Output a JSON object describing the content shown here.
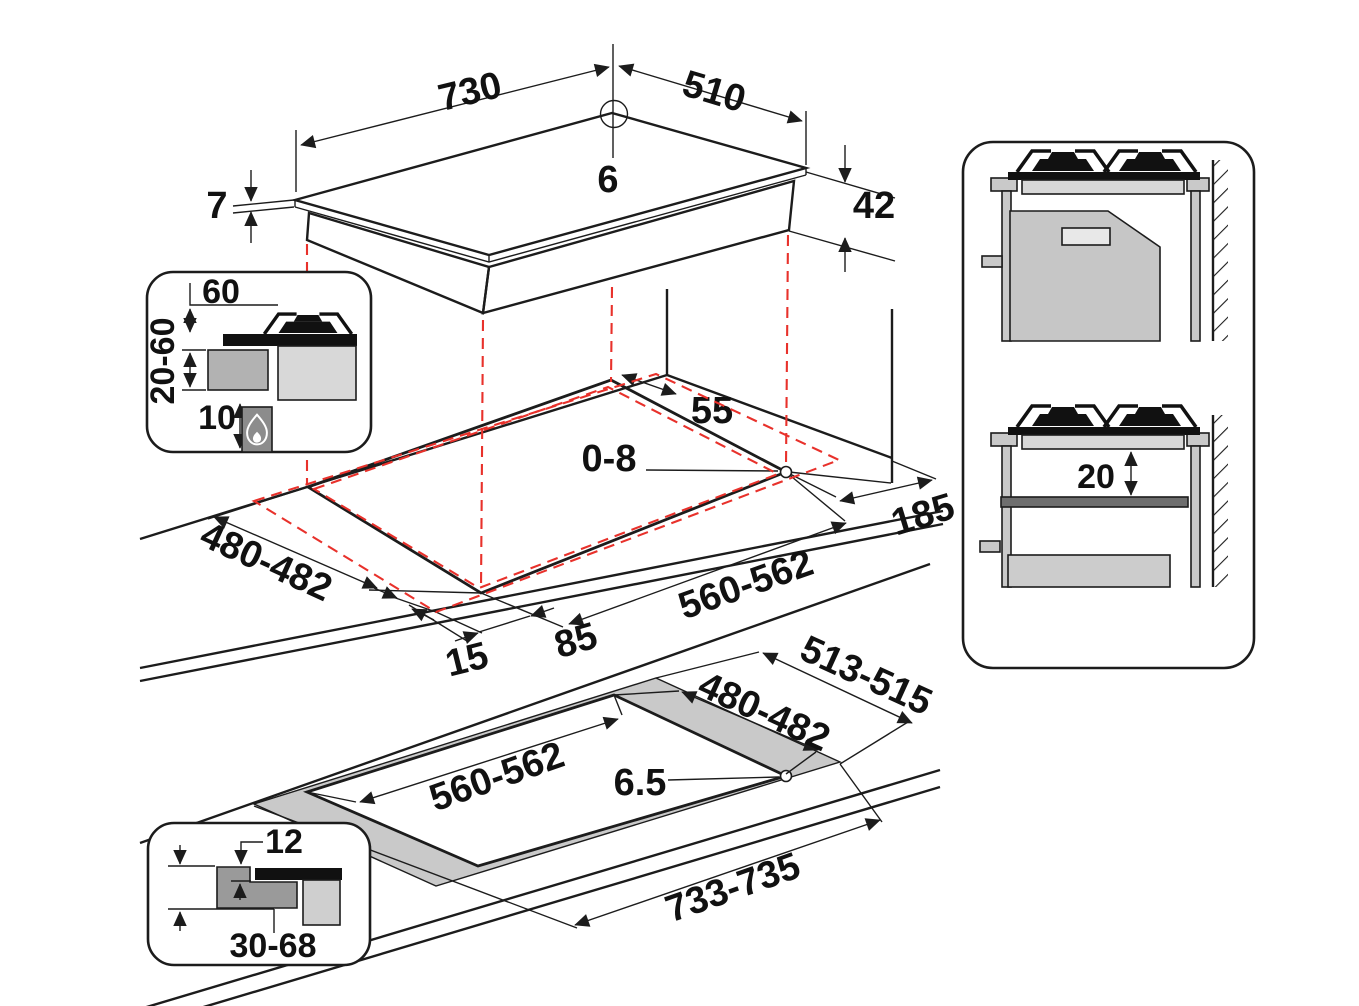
{
  "title": "Hob installation dimensions diagram",
  "colors": {
    "bg": "#ffffff",
    "line": "#1c1c1c",
    "red": "#e8312b",
    "gray_light": "#d8d8d8",
    "gray_mid": "#b2b2b2",
    "gray_dark": "#8c8c8c"
  },
  "top_view": {
    "width": "730",
    "depth": "510",
    "glass_thickness": "6",
    "total_height": "42",
    "rim_thickness": "7"
  },
  "install_inset": {
    "top_clearance": "60",
    "side_clearance": "20-60",
    "gas_clearance": "10",
    "flame_icon": "gas-flame"
  },
  "worktop_view": {
    "rear_wall_distance": "55",
    "corner_gap": "0-8",
    "side_wall_distance": "185",
    "cutout_depth": "480-482",
    "cutout_width": "560-562",
    "front_overhang": "85",
    "side_overhang": "15"
  },
  "flush_view": {
    "recess_depth": "513-515",
    "cutout_depth": "480-482",
    "cutout_width": "560-562",
    "corner_radius": "6.5",
    "recess_width": "733-735"
  },
  "flush_inset": {
    "recess_step": "12",
    "worktop_thickness": "30-68"
  },
  "cabinet_section": {
    "min_shelf_gap": "20"
  }
}
